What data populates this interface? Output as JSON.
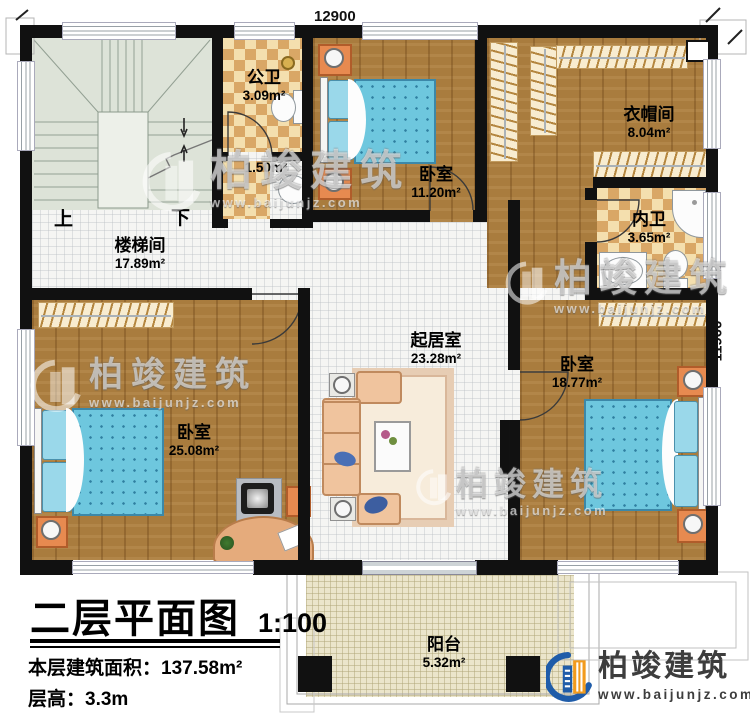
{
  "dimensions": {
    "top": "12900",
    "right": "11900"
  },
  "rooms": [
    {
      "id": "stairwell",
      "name": "楼梯间",
      "area": "17.89m²"
    },
    {
      "id": "public-bath",
      "name": "公卫",
      "area": "3.09m²"
    },
    {
      "id": "wash-nook",
      "name": "",
      "area": "1.50m²"
    },
    {
      "id": "bedroom-top",
      "name": "卧室",
      "area": "11.20m²"
    },
    {
      "id": "cloakroom",
      "name": "衣帽间",
      "area": "8.04m²"
    },
    {
      "id": "ensuite-bath",
      "name": "内卫",
      "area": "3.65m²"
    },
    {
      "id": "living-room",
      "name": "起居室",
      "area": "23.28m²"
    },
    {
      "id": "bedroom-right",
      "name": "卧室",
      "area": "18.77m²"
    },
    {
      "id": "bedroom-left",
      "name": "卧室",
      "area": "25.08m²"
    },
    {
      "id": "balcony",
      "name": "阳台",
      "area": "5.32m²"
    }
  ],
  "stairs": {
    "up": "上",
    "down": "下"
  },
  "title_block": {
    "title": "二层平面图",
    "scale": "1:100",
    "area_label": "本层建筑面积：",
    "area_value": "137.58m²",
    "height_label": "层高：",
    "height_value": "3.3m"
  },
  "branding": {
    "company": "柏竣建筑",
    "website": "www.baijunjz.com"
  },
  "colors": {
    "wall": "#111111",
    "wood": "#a97c3e",
    "checker_dark": "#d9a766",
    "checker_light": "#f4dfae",
    "stair": "#dde3d8",
    "mattress": "#6ec7de",
    "nightstand_orange": "#e78a50",
    "logo_blue": "#1f5ca9",
    "logo_orange": "#f29b1d"
  }
}
